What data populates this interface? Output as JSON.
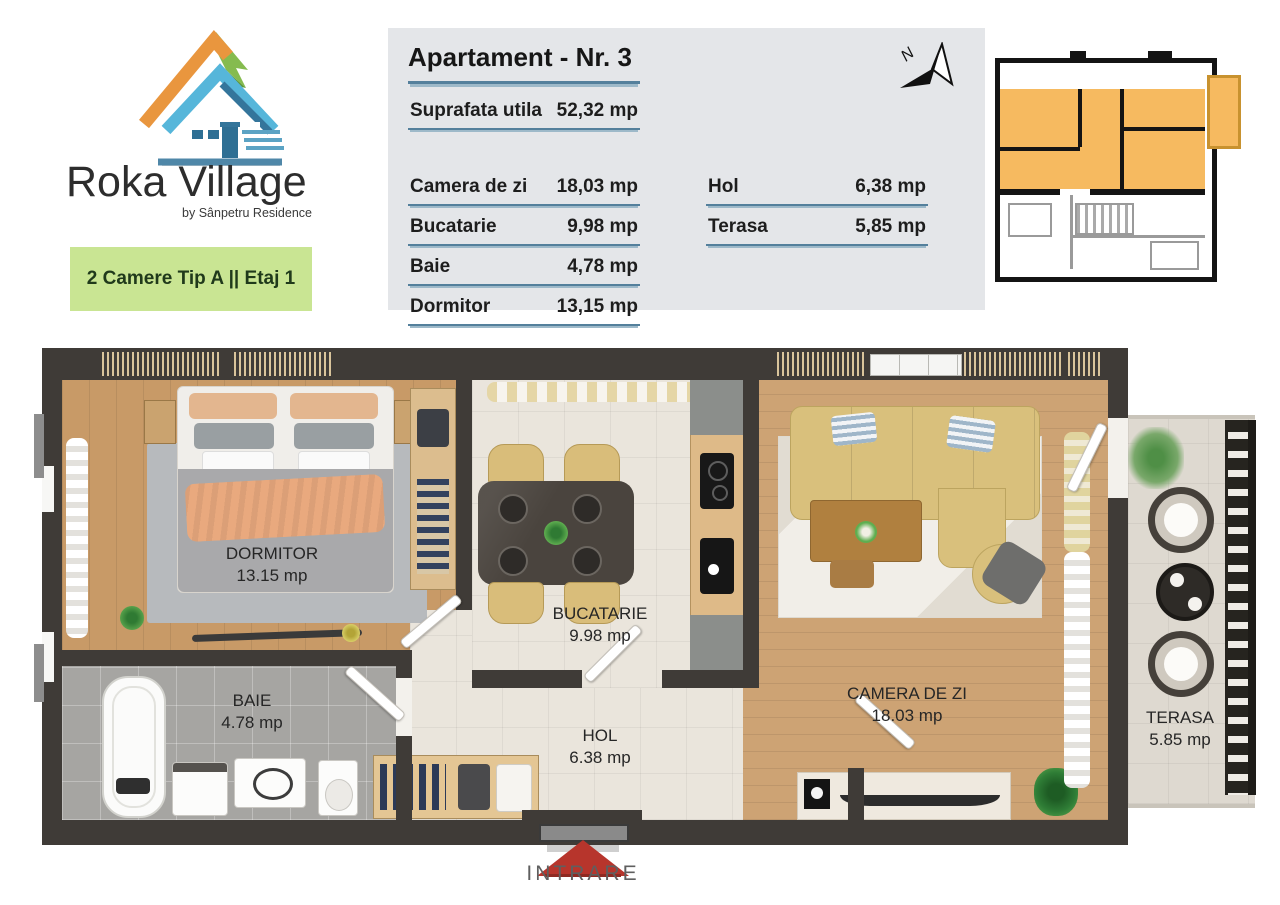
{
  "brand": {
    "name": "Roka Village",
    "tagline": "by Sânpetru Residence"
  },
  "badge": {
    "label": "2 Camere Tip A || Etaj 1"
  },
  "info_panel": {
    "title": "Apartament - Nr. 3",
    "total": {
      "label": "Suprafata utila",
      "value": "52,32 mp"
    },
    "rooms_left": [
      {
        "label": "Camera de zi",
        "value": "18,03 mp"
      },
      {
        "label": "Bucatarie",
        "value": "9,98 mp"
      },
      {
        "label": "Baie",
        "value": "4,78 mp"
      },
      {
        "label": "Dormitor",
        "value": "13,15 mp"
      }
    ],
    "rooms_right": [
      {
        "label": "Hol",
        "value": "6,38 mp"
      },
      {
        "label": "Terasa",
        "value": "5,85 mp"
      }
    ]
  },
  "compass": {
    "label": "N"
  },
  "floor_plan": {
    "rooms": [
      {
        "label": "DORMITOR",
        "area": "13.15 mp"
      },
      {
        "label": "BAIE",
        "area": "4.78 mp"
      },
      {
        "label": "BUCATARIE",
        "area": "9.98 mp"
      },
      {
        "label": "HOL",
        "area": "6.38 mp"
      },
      {
        "label": "CAMERA DE ZI",
        "area": "18.03 mp"
      },
      {
        "label": "TERASA",
        "area": "5.85 mp"
      }
    ],
    "entrance_label": "INTRARE"
  },
  "colors": {
    "accent_green": "#c9e593",
    "panel_bg": "#e4e6e9",
    "underline": "#54809c",
    "wall": "#3f3b37",
    "highlight_orange": "#f6ba60",
    "entrance_red": "#b7352c"
  }
}
